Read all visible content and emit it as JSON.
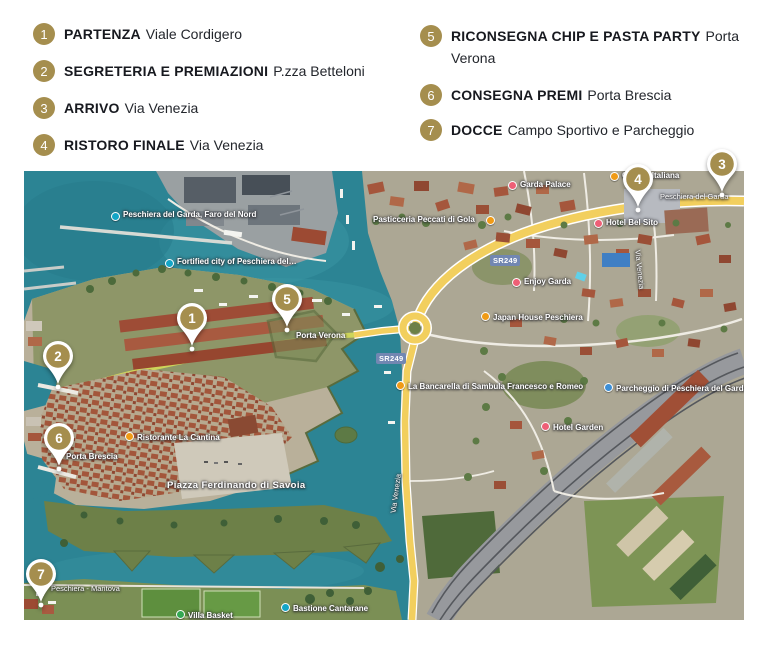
{
  "legend": {
    "items": [
      {
        "num": "1",
        "label": "PARTENZA",
        "location": "Viale Cordigero"
      },
      {
        "num": "2",
        "label": "SEGRETERIA E PREMIAZIONI",
        "location": "P.zza Betteloni"
      },
      {
        "num": "3",
        "label": "ARRIVO",
        "location": "Via Venezia"
      },
      {
        "num": "4",
        "label": "RISTORO FINALE",
        "location": "Via Venezia"
      },
      {
        "num": "5",
        "label": "RICONSEGNA CHIP E PASTA PARTY",
        "location": "Porta Verona"
      },
      {
        "num": "6",
        "label": "CONSEGNA PREMI",
        "location": "Porta Brescia"
      },
      {
        "num": "7",
        "label": "DOCCE",
        "location": "Campo Sportivo e Parcheggio"
      }
    ]
  },
  "map": {
    "pins": [
      "1",
      "2",
      "3",
      "4",
      "5",
      "6",
      "7"
    ],
    "labels": {
      "faro": "Peschiera del Garda, Faro del Nord",
      "fortified_city": "Fortified city of Peschiera del…",
      "pasticceria": "Pasticceria Peccati di Gola",
      "garda_palace": "Garda Palace",
      "osteria": "Osteria Italiana",
      "bel_sito": "Hotel Bel Sito",
      "enjoy_garda": "Enjoy Garda",
      "japan_house": "Japan House Peschiera",
      "porta_verona": "Porta Verona",
      "sr249": "SR249",
      "bancarella": "La Bancarella di Sambula Francesco e Romeo",
      "parcheggio": "Parcheggio di Peschiera del Garda",
      "hotel_garden": "Hotel Garden",
      "piazza": "Piazza Ferdinando di Savoia",
      "porta_brescia": "Porta Brescia",
      "ristorante": "Ristorante La Cantina",
      "bastione": "Bastione Cantarane",
      "ciclabile": "Peschiera - Mantova",
      "villa_basket": "Villa Basket",
      "via_venezia": "Via Venezia",
      "top_road": "Peschiera del Garda"
    },
    "colors": {
      "pin_gold": "#a58e4e",
      "water": "#2c8494",
      "route_glow": "#e3ea55",
      "road_yellow": "#f2cf5e"
    }
  }
}
